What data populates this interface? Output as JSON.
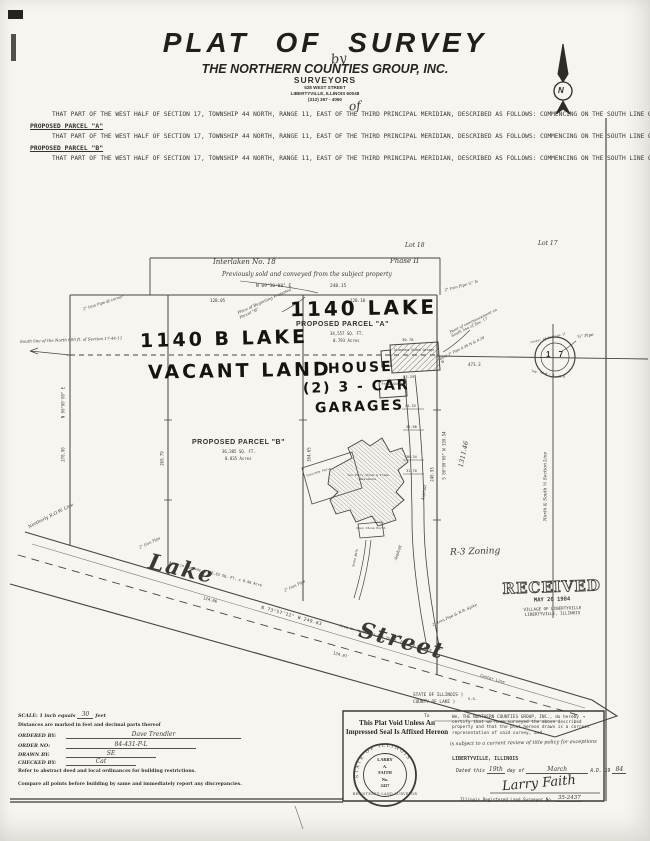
{
  "header": {
    "title": "PLAT OF SURVEY",
    "by": "by",
    "company": "THE NORTHERN COUNTIES GROUP, INC.",
    "surveyors": "SURVEYORS",
    "address": "528 WEST STREET",
    "city": "LIBERTYVILLE,  ILLINOIS      60048",
    "phone": "(312)  367 - 4060",
    "of": "of"
  },
  "legal": {
    "para1": "THAT PART OF THE WEST HALF OF SECTION 17, TOWNSHIP 44 NORTH, RANGE 11, EAST OF THE THIRD PRINCIPAL MERIDIAN, DESCRIBED AS FOLLOWS:  COMMENCING ON THE SOUTH LINE OF THE NORTHWEST QUARTER OF SAID SECTION AT A POINT 473.3 FEET WEST OF THE CENTER OF SAID SECTION;  RUNNING THENCE NORTH 664.3 FEET;  THENCE WEST 248.1 FEET;  THENCE SOUTH 870 FEET TO THE CENTER OF THE HIGHWAY;  THENCE SOUTHEASTERLY ALONG THE CENTER OF SAID HIGHWAY, 249.7 FEET TO A POINT DUE SOUTH OF THE PLACE OF BEGINNING;  THENCE NORTH TO THE PLACE OF BEGINNING (excepting therefrom the North 600 feet more or less), IN LIBERTYVILLE, LAKE COUNTY, ILLINOIS.",
    "parcel_a_heading": "PROPOSED PARCEL \"A\"",
    "para2": "THAT PART OF THE WEST HALF OF SECTION 17, TOWNSHIP 44 NORTH, RANGE 11, EAST OF THE THIRD PRINCIPAL MERIDIAN, DESCRIBED AS FOLLOWS:  COMMENCING ON THE SOUTH LINE OF THE NORTHWEST QUARTER OF SAID SECTION AT A POINT 473.3 FEET WEST OF THE CENTER OF SAID SECTION;  THENCE NORTH AND PARALLEL WITH THE EAST LINE OF SAID NORTHWEST QUARTER 64.25 FEET;  THENCE S 89°36'08\" W AND PARALLEL WITH THE SOUTH LINE OF THE NORTHWEST QUARTER OF SAID SECTION, 120.10 FEET;  THENCE SOUTH AND PARALLEL WITH THE EAST LINE OF SAID NORTHWEST QUARTER, 304.65 FEET TO THE CENTER OF THE HIGHWAY (Lake Street);  THENCE S 73°57'12\" E ALONG THE CENTER OF SAID HIGHWAY, 124.97 FEET;  THENCE NORTH AND PARALLEL WITH SAID EAST LINE OF THE NORTHWEST QUARTER, 275.29 FEET TO THE PLACE OF BEGINNING.  ALL IN LAKE COUNTY, ILLINOIS.",
    "parcel_b_heading": "PROPOSED PARCEL \"B\"",
    "para3": "THAT PART OF THE WEST HALF OF SECTION 17, TOWNSHIP 44 NORTH, RANGE 11, EAST OF THE THIRD PRINCIPAL MERIDIAN, DESCRIBED AS FOLLOWS:  COMMENCING ON THE SOUTH LINE OF THE NORTHWEST QUARTER OF SAID SECTION AT A POINT 473.3 FEET WEST OF THE CENTER OF SAID SECTION;  THENCE NORTH AND PARALLEL WITH THE EAST LINE OF SAID NORTHWEST QUARTER 64.25 FEET;  THENCE S 89°36'08\" W AND PARALLEL WITH THE SOUTH LINE OF THE NORTHWEST QUARTER OF SAID SECTION, 120.10 FEET TO THE PLACE OF BEGINNING;  THENCE CONTINUING WEST ALONG THE LAST DESCRIBED COURSE, 128.05 FEET;  THENCE SOUTH AND PARALLEL WITH SAID EAST LINE OF THE NORTHWEST QUARTER, 269.79 FEET TO THE CENTER OF THE HIGHWAY (Lake Street);  THENCE S 73°57'12\" E ALONG THE CENTER OF SAID HIGHWAY, 124.86 FEET;  THENCE NORTH AND PARALLEL WITH SAID EAST LINE OF THE NORTHWEST QUARTER, 304.65 FEET TO THE PLACE OF BEGINNING.  ALL IN LAKE COUNTY, ILLINOIS."
  },
  "map": {
    "lot18": "Lot 18",
    "lot17": "Lot 17",
    "subdivision": "Interlaken  No. 18",
    "phase": "Phase II",
    "sold_note": "Previously sold and conveyed from the subject property",
    "top_bearing": "N 89°30'08\" E",
    "top_dist": "248.15",
    "seg_b": "128.05",
    "seg_a": "120.10",
    "addr_a": "1140 LAKE",
    "parcel_a": "PROPOSED PARCEL \"A\"",
    "area_a_sf": "34,557 SQ. FT.",
    "area_a_ac": "0.793 Acres",
    "addr_b": "1140 B LAKE",
    "vacant": "VACANT LAND",
    "house_1": "HOUSE",
    "house_2": "(2) 3 - CAR",
    "house_3": "GARAGES",
    "parcel_b": "PROPOSED PARCEL \"B\"",
    "area_b_sf": "36,385 SQ. FT.",
    "area_b_ac": "0.835 Acres",
    "south600": "South line of the North 600 ft. of Section 17-44-11",
    "pob_b_note": "Place of Beginning Proposed Parcel \"B\"",
    "poc_note": "Point of commencement on South line of Sec. 17",
    "bent_note": "Bent 2\" Pipe 0.36 N & 0.28 W",
    "pipe_tl": "2\" Iron Pipe @ corner",
    "pipe_tr": "2\" Iron Pipe ½\" N",
    "pipe_rd1": "2\" Iron Pipe",
    "pipe_rd2": "2\" Iron Pipe",
    "pipe_rd3": "2\" Iron Pipe & R.R. Spike",
    "pipe_34": "¾\" Pipe",
    "dim_473": "473.3",
    "sec_center_top": "Center of Section 17",
    "sec_center_bot": "Twp. 44 N — R. 11 E",
    "sec_num": "1 7",
    "quarter_line": "North & South ¼ Section Line",
    "dim_269": "269.79",
    "dim_304": "304.65",
    "dim_left_bearing": "N 00°00'00\" E",
    "dim_left": "270.00",
    "dim_east_bearing": "S 00°00'00\" W  339.54",
    "dim_east": "240.93",
    "dim_hand": "1311.46",
    "garage1": "Aluminum Sided Garage",
    "garage1_dim_top": "30.70",
    "garage1_dim_bot": "33.25",
    "garage2": "Frame Garage",
    "drive_dims": [
      "34.33",
      "30.98",
      "36.34",
      "31.70"
    ],
    "asphalt": "Asphalt",
    "house_tiny": "Two Story Stone & Frame Residence",
    "porch": "Open Stone Porch",
    "walk": "Stone Walk",
    "patio": "Concrete Patio",
    "rzone": "R-3 Zoning",
    "row_line": "Northerly R.O.W. Line",
    "lake": "Lake",
    "street": "Street",
    "road_bearing": "N 73°57'12\" W    249.83",
    "dim_12486": "124.86",
    "dim_12497": "124.97",
    "area_road1": "Area in roadway  4,186.63 SQ. FT. ± 0.96 Acre",
    "area_road2": "Area in roadway  4,084.25 SQ. FT. ± 0.93 Acre",
    "center_line": "Center Line",
    "state1": "STATE OF ILLINOIS )",
    "ss": "S.S.",
    "state2": "COUNTY OF LAKE )",
    "to": "To",
    "received_1": "RECEIVED",
    "received_2": "MAY 20 1984",
    "received_3": "VILLAGE OF LIBERTYVILLE",
    "received_4": "LIBERTYVILLE, ILLINOIS",
    "north": "N"
  },
  "footer": {
    "left": {
      "scale_label": "SCALE: 1 inch equals",
      "scale_val": "30",
      "scale_unit": "feet",
      "distances": "Distances are marked in feet and decimal parts thereof",
      "ordered_label": "ORDERED BY:",
      "ordered_val": "Dave Trendler",
      "orderno_label": "ORDER NO:",
      "orderno_val": "84-431-P-L",
      "drawn_label": "DRAWN BY:",
      "drawn_val": "SE",
      "checked_label": "CHECKED BY:",
      "checked_val": "Cat",
      "refer": "Refer to abstract deed and local ordinances for building restrictions.",
      "compare": "Compare all points before building by same and immediately report any discrepancies."
    },
    "center": {
      "void_1": "This Plat Void Unless An",
      "void_2": "Impressed Seal Is Affixed Hereon",
      "seal_arc": "STATE OF ILLINOIS",
      "seal_l1": "LARRY",
      "seal_l2": "A.",
      "seal_l3": "FAITH",
      "seal_l4": "No.",
      "seal_l5": "2437",
      "seal_bottom": "REGISTERED LAND SURVEYOR"
    },
    "right": {
      "cert": "We, THE NORTHERN COUNTIES GROUP, INC., do hereby certify that we have surveyed the above described property and that the plat hereon drawn is a correct representation of said survey, and",
      "cert_hand": "is subject to a current review of title policy for exceptions",
      "city": "LIBERTYVILLE, ILLINOIS",
      "dated_1": "Dated this",
      "dated_day": "19th",
      "dated_2": "day of",
      "dated_month": "March",
      "dated_3": "A.D. 19",
      "dated_year": "84",
      "signature": "Larry Faith",
      "license_label": "Illinois Registered Land Surveyor No.",
      "license_no": "35-2437"
    }
  }
}
